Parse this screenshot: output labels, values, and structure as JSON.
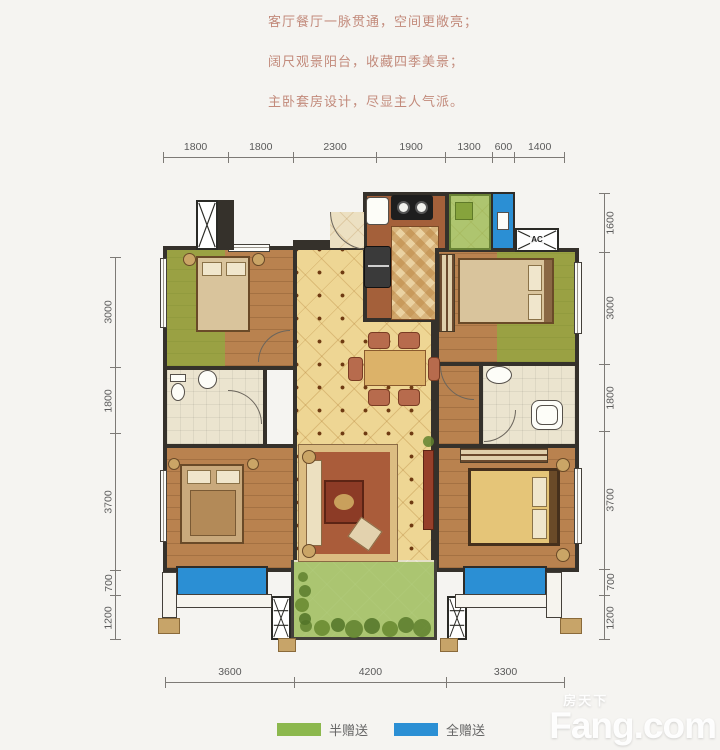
{
  "tagline": {
    "lines": [
      "客厅餐厅一脉贯通，空间更敞亮；",
      "阔尺观景阳台，收藏四季美景；",
      "主卧套房设计，尽显主人气派。"
    ],
    "color": "#c28a7b"
  },
  "dimensions": {
    "top": [
      "1800",
      "1800",
      "2300",
      "1900",
      "1300",
      "600",
      "1400"
    ],
    "left": [
      "3000",
      "1800",
      "3700",
      "700",
      "1200"
    ],
    "right": [
      "1600",
      "3000",
      "1800",
      "3700",
      "700",
      "1200"
    ],
    "bottom": [
      "3600",
      "4200",
      "3300"
    ]
  },
  "plan": {
    "ac_label": "AC"
  },
  "legend": {
    "items": [
      {
        "label": "半赠送",
        "color": "#8cb84e"
      },
      {
        "label": "全赠送",
        "color": "#2b8fd4"
      }
    ]
  },
  "watermark": {
    "brand_cn": "房天下",
    "brand_en": "Fang.com"
  },
  "colors": {
    "wall": "#35312b",
    "tile_floor": "#eed694",
    "wood_floor": "#b9824f",
    "bath_floor": "#ebe4cf",
    "half_gift_green": "#8cb84e",
    "full_gift_blue": "#2b8fd4",
    "tagline_text": "#c28a7b",
    "dimension_text": "#5a5a5a"
  }
}
